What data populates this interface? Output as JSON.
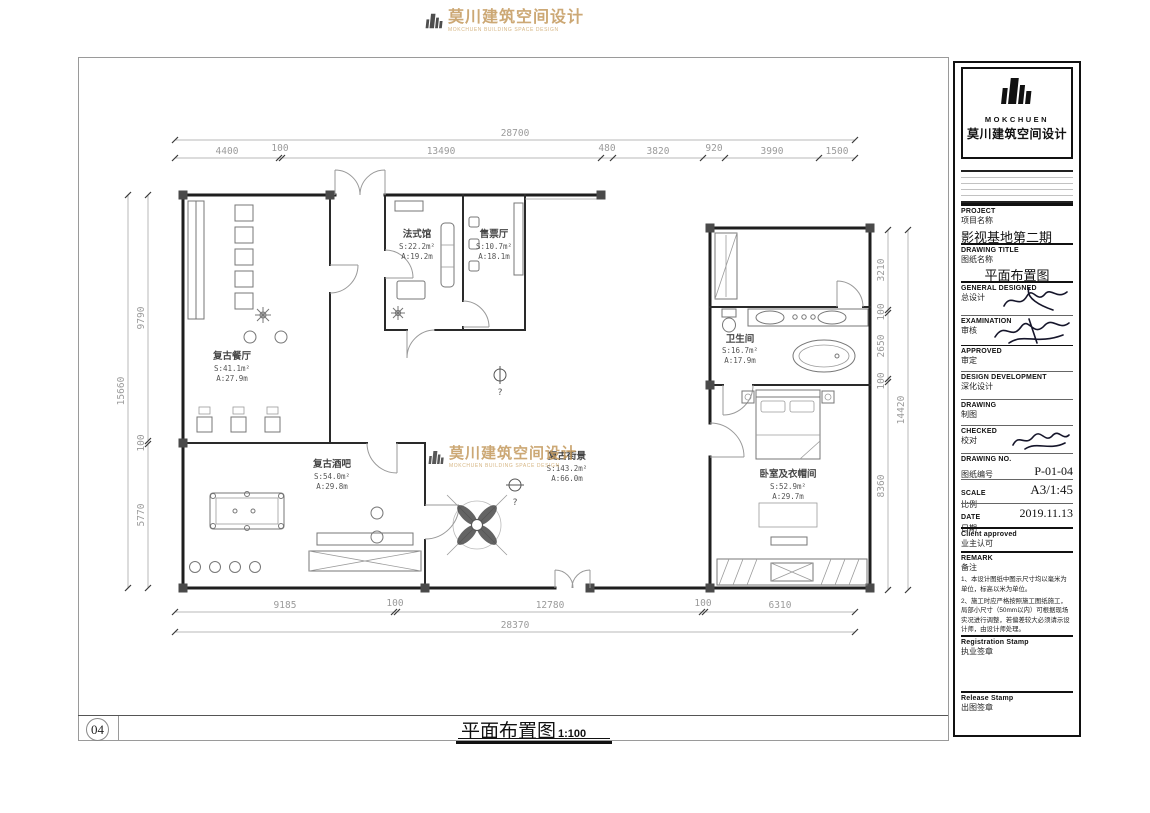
{
  "page": {
    "number": "04",
    "footer_title": "平面布置图",
    "footer_scale": "1:100"
  },
  "brand": {
    "name_en": "MOKCHUEN",
    "name_cn": "莫川建筑空间设计",
    "tagline_en": "MOKCHUEN BUILDING SPACE DESIGN",
    "gold": "#c49a5d"
  },
  "title_block": {
    "project": {
      "label_en": "PROJECT",
      "label_cn": "项目名称",
      "value": "影视基地第二期"
    },
    "drawing_title": {
      "label_en": "DRAWING TITLE",
      "label_cn": "图纸名称",
      "value": "平面布置图"
    },
    "general_designed": {
      "label_en": "GENERAL  DESIGNED",
      "label_cn": "总设计"
    },
    "examination": {
      "label_en": "EXAMINATION",
      "label_cn": "审核"
    },
    "approved": {
      "label_en": "APPROVED",
      "label_cn": "审定"
    },
    "design_development": {
      "label_en": "DESIGN DEVELOPMENT",
      "label_cn": "深化设计"
    },
    "drawing": {
      "label_en": "DRAWING",
      "label_cn": "制图"
    },
    "checked": {
      "label_en": "CHECKED",
      "label_cn": "校对"
    },
    "drawing_no": {
      "label_en": "DRAWING NO.",
      "label_cn": "图纸编号",
      "value": "P-01-04"
    },
    "scale": {
      "label_en": "SCALE",
      "label_cn": "比例",
      "value": "A3/1:45"
    },
    "date": {
      "label_en": "DATE",
      "label_cn": "日期",
      "value": "2019.11.13"
    },
    "client": {
      "label_en": "Client approved",
      "label_cn": "业主认可"
    },
    "remark": {
      "label_en": "REMARK",
      "label_cn": "备注",
      "notes": [
        "1、本设计图纸中图示尺寸均以毫米为单位，标高以米为单位。",
        "2、施工时应严格按照施工图纸施工，局部小尺寸（50mm以内）可根据现场实况进行调整，若偏差较大必须请示设计师，由设计师处理。"
      ]
    },
    "registration_stamp": {
      "label_en": "Registration Stamp",
      "label_cn": "执业签章"
    },
    "release_stamp": {
      "label_en": "Release Stamp",
      "label_cn": "出图签章"
    }
  },
  "plan": {
    "rooms": [
      {
        "name": "法式馆",
        "area": "S:22.2m²",
        "perimeter": "A:19.2m"
      },
      {
        "name": "售票厅",
        "area": "S:10.7m²",
        "perimeter": "A:18.1m"
      },
      {
        "name": "复古餐厅",
        "area": "S:41.1m²",
        "perimeter": "A:27.9m"
      },
      {
        "name": "复古酒吧",
        "area": "S:54.0m²",
        "perimeter": "A:29.8m"
      },
      {
        "name": "复古街景",
        "area": "S:143.2m²",
        "perimeter": "A:66.0m"
      },
      {
        "name": "卫生间",
        "area": "S:16.7m²",
        "perimeter": "A:17.9m"
      },
      {
        "name": "卧室及衣帽间",
        "area": "S:52.9m²",
        "perimeter": "A:29.7m"
      }
    ],
    "markers": [
      "?",
      "?"
    ],
    "dimensions": {
      "top_total": "28700",
      "top_segments": [
        "4400",
        "100",
        "13490",
        "480",
        "3820",
        "920",
        "3990",
        "1500"
      ],
      "bottom_segments": [
        "9185",
        "100",
        "12780",
        "100",
        "6310"
      ],
      "bottom_total": "28370",
      "left_total": "15660",
      "left_segments": [
        "9790",
        "100",
        "5770"
      ],
      "right_total": "14420",
      "right_segments": [
        "3210",
        "100",
        "2650",
        "100",
        "8360"
      ]
    }
  }
}
